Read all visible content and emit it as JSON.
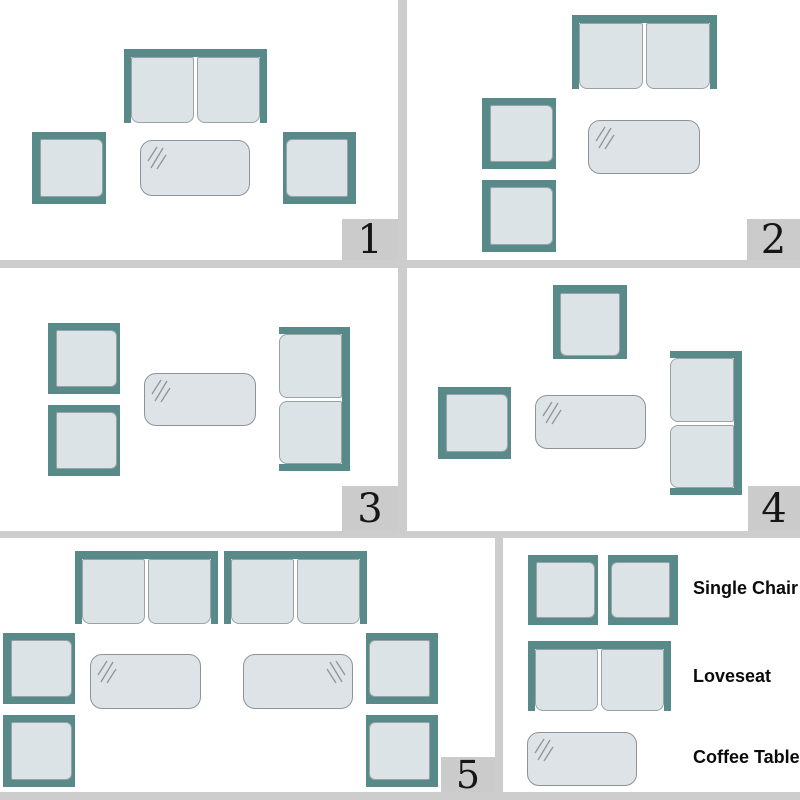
{
  "diagram": {
    "kind": "patio-furniture-arrangement-layouts",
    "panel_count": 5
  },
  "colors": {
    "teal": "#578a88",
    "cushion": "#dce3e6",
    "cushion_border": "#9aa2a6",
    "table_fill": "#dde3e7",
    "table_border": "#8e9397",
    "shine": "#8d959b",
    "divider": "#cdcdcd",
    "badge_bg": "#cbcbcb",
    "number": "#161616",
    "label": "#0b0b0b"
  },
  "panels": [
    {
      "number": "1",
      "furniture": [
        {
          "type": "loveseat",
          "facing": "down",
          "x": 124,
          "y": 49,
          "w": 143,
          "h": 74
        },
        {
          "type": "chair",
          "facing": "right",
          "x": 32,
          "y": 132,
          "w": 74,
          "h": 72
        },
        {
          "type": "table",
          "shine": "tl",
          "x": 140,
          "y": 140,
          "w": 110,
          "h": 56
        },
        {
          "type": "chair",
          "facing": "left",
          "x": 283,
          "y": 132,
          "w": 73,
          "h": 72
        }
      ]
    },
    {
      "number": "2",
      "furniture": [
        {
          "type": "loveseat",
          "facing": "down",
          "x": 572,
          "y": 15,
          "w": 145,
          "h": 74
        },
        {
          "type": "chair",
          "facing": "right",
          "x": 482,
          "y": 98,
          "w": 74,
          "h": 71
        },
        {
          "type": "chair",
          "facing": "right",
          "x": 482,
          "y": 180,
          "w": 74,
          "h": 72
        },
        {
          "type": "table",
          "shine": "tl",
          "x": 588,
          "y": 120,
          "w": 112,
          "h": 54
        }
      ]
    },
    {
      "number": "3",
      "furniture": [
        {
          "type": "chair",
          "facing": "right",
          "x": 48,
          "y": 323,
          "w": 72,
          "h": 71
        },
        {
          "type": "chair",
          "facing": "right",
          "x": 48,
          "y": 405,
          "w": 72,
          "h": 71
        },
        {
          "type": "table",
          "shine": "tl",
          "x": 144,
          "y": 373,
          "w": 112,
          "h": 53
        },
        {
          "type": "loveseat",
          "facing": "left",
          "x": 279,
          "y": 327,
          "w": 71,
          "h": 144
        }
      ]
    },
    {
      "number": "4",
      "furniture": [
        {
          "type": "chair",
          "facing": "down",
          "x": 553,
          "y": 285,
          "w": 74,
          "h": 74
        },
        {
          "type": "chair",
          "facing": "right",
          "x": 438,
          "y": 387,
          "w": 73,
          "h": 72
        },
        {
          "type": "table",
          "shine": "tl",
          "x": 535,
          "y": 395,
          "w": 111,
          "h": 54
        },
        {
          "type": "loveseat",
          "facing": "left",
          "x": 670,
          "y": 351,
          "w": 72,
          "h": 144
        }
      ]
    },
    {
      "number": "5",
      "furniture": [
        {
          "type": "loveseat",
          "facing": "down",
          "x": 75,
          "y": 551,
          "w": 143,
          "h": 73
        },
        {
          "type": "loveseat",
          "facing": "down",
          "x": 224,
          "y": 551,
          "w": 143,
          "h": 73
        },
        {
          "type": "chair",
          "facing": "right",
          "x": 3,
          "y": 633,
          "w": 72,
          "h": 71
        },
        {
          "type": "chair",
          "facing": "right",
          "x": 3,
          "y": 715,
          "w": 72,
          "h": 72
        },
        {
          "type": "table",
          "shine": "tl",
          "x": 90,
          "y": 654,
          "w": 111,
          "h": 55
        },
        {
          "type": "table",
          "shine": "tr",
          "x": 243,
          "y": 654,
          "w": 110,
          "h": 55
        },
        {
          "type": "chair",
          "facing": "left",
          "x": 366,
          "y": 633,
          "w": 72,
          "h": 71
        },
        {
          "type": "chair",
          "facing": "left",
          "x": 366,
          "y": 715,
          "w": 72,
          "h": 72
        }
      ]
    }
  ],
  "legend": {
    "items": [
      {
        "label": "Single Chair"
      },
      {
        "label": "Loveseat"
      },
      {
        "label": "Coffee Table"
      }
    ],
    "furniture": [
      {
        "type": "chair",
        "facing": "right",
        "x": 528,
        "y": 555,
        "w": 70,
        "h": 70
      },
      {
        "type": "chair",
        "facing": "left",
        "x": 608,
        "y": 555,
        "w": 70,
        "h": 70
      },
      {
        "type": "loveseat",
        "facing": "down",
        "x": 528,
        "y": 641,
        "w": 143,
        "h": 70
      },
      {
        "type": "table",
        "shine": "tl",
        "x": 527,
        "y": 732,
        "w": 110,
        "h": 54
      }
    ]
  }
}
